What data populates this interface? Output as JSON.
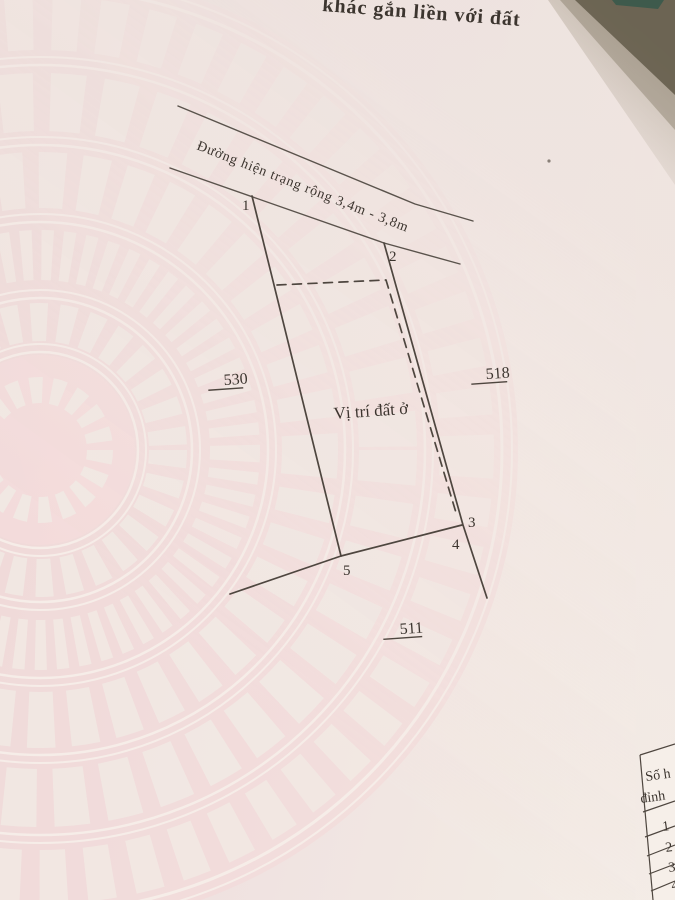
{
  "page": {
    "heading_fragment": "khác gắn liền với đất",
    "road_label": "Đường hiện trạng rộng 3,4m - 3,8m",
    "plot_label": "Vị trí đất ở",
    "parcel_numbers": {
      "left": "530",
      "right": "518",
      "bottom": "511"
    },
    "vertex_labels": [
      "1",
      "2",
      "3",
      "4",
      "5"
    ],
    "table": {
      "header_line1": "Số h",
      "header_line2": "đỉnh",
      "rows": [
        "1",
        "2",
        "3",
        "4"
      ]
    },
    "colors": {
      "paper": "#efe3e0",
      "ink": "#3c352f",
      "sketch_line": "#4e463f",
      "drum_pink": "#f4d8d9",
      "shadow_dark": "#675f4e",
      "teal_corner": "#3e5a4c"
    }
  }
}
